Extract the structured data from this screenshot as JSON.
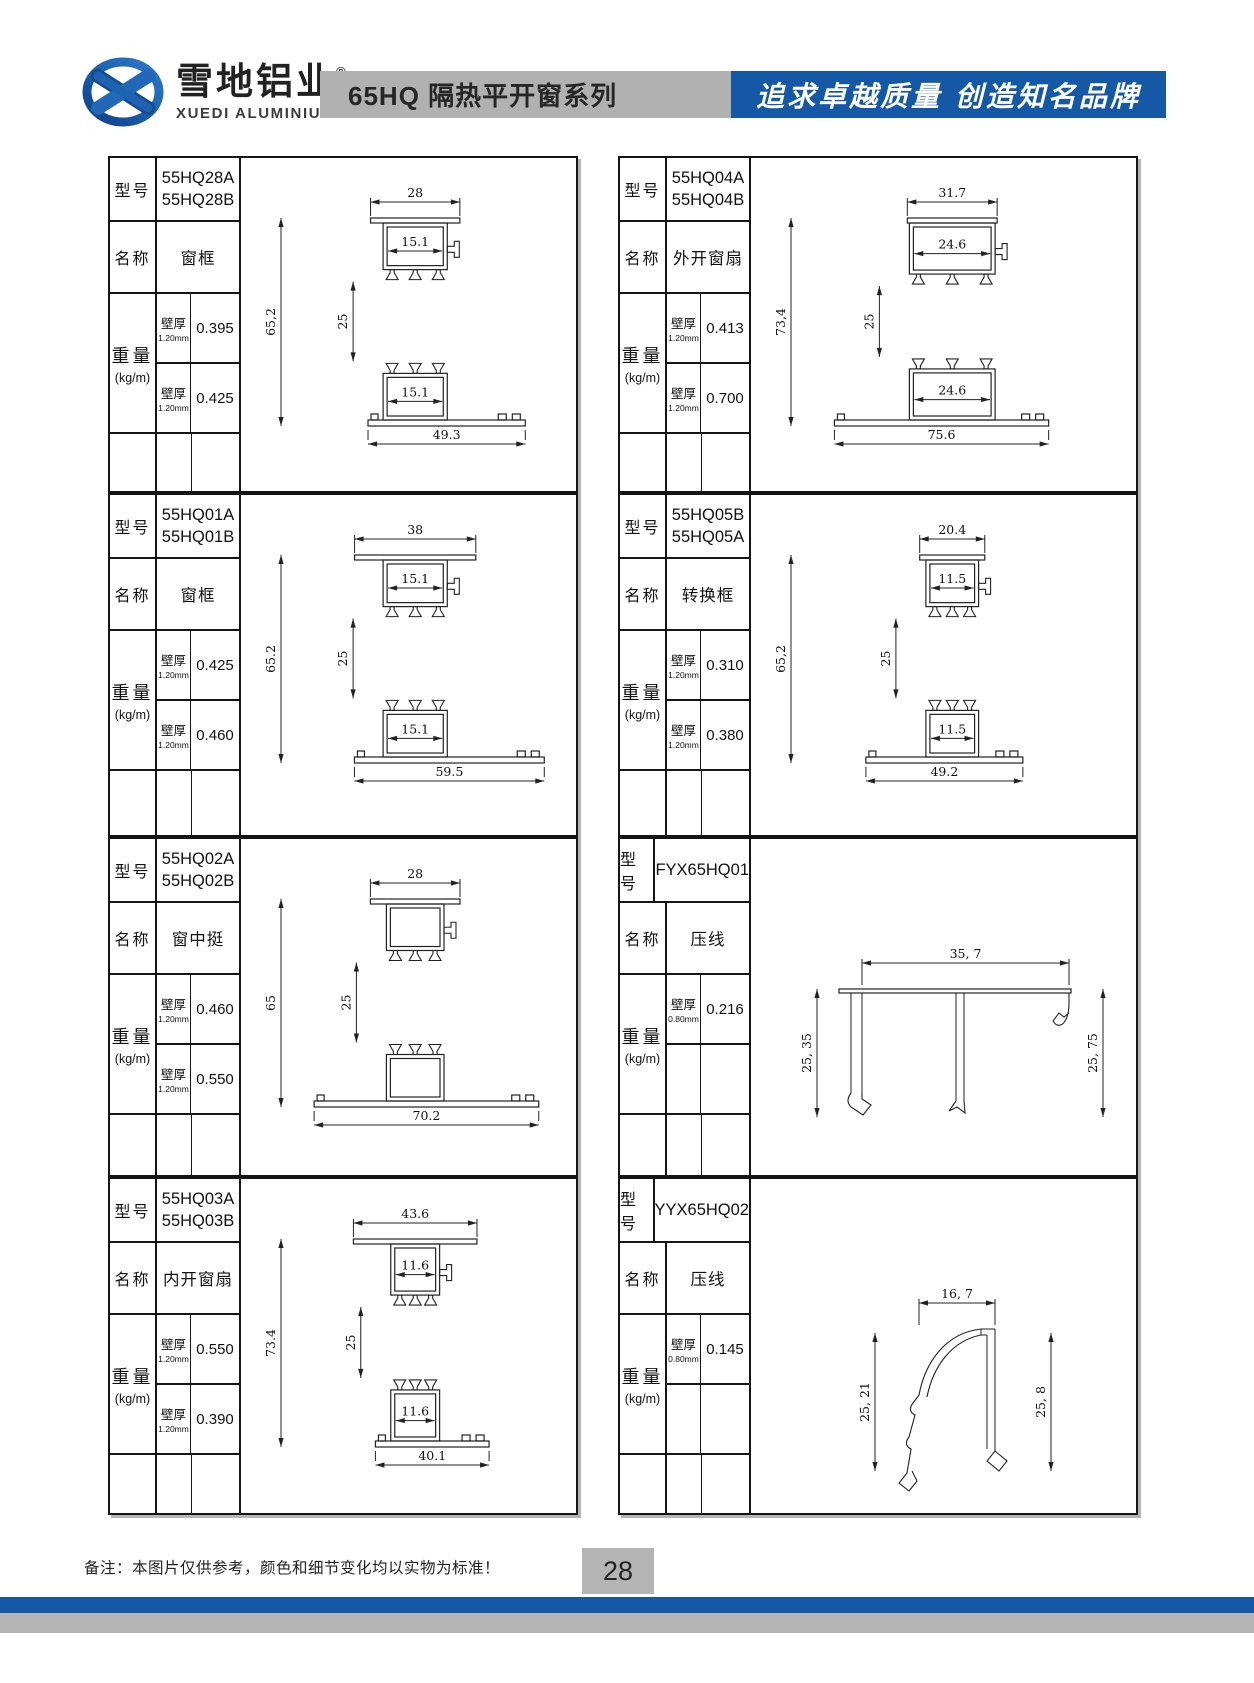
{
  "header": {
    "logo_cn": "雪地铝业",
    "logo_reg": "®",
    "logo_en": "XUEDI ALUMINIUM",
    "series_title": "65HQ 隔热平开窗系列",
    "slogan": "追求卓越质量 创造知名品牌",
    "colors": {
      "accent_blue": "#1458a6",
      "bar_gray": "#b1b1b1"
    }
  },
  "labels": {
    "model": "型号",
    "name": "名称",
    "weight": "重量",
    "weight_unit": "(kg/m)",
    "wall": "壁厚"
  },
  "cells": [
    {
      "models": [
        "55HQ28A",
        "55HQ28B"
      ],
      "name": "窗框",
      "weights": [
        {
          "wall": "1.20mm",
          "value": "0.395"
        },
        {
          "wall": "1.20mm",
          "value": "0.425"
        }
      ],
      "dims": {
        "top": "28",
        "inner_top": "15.1",
        "height": "65,2",
        "mid": "25",
        "inner_bottom": "15.1",
        "bottom": "49.3"
      }
    },
    {
      "models": [
        "55HQ04A",
        "55HQ04B"
      ],
      "name": "外开窗扇",
      "weights": [
        {
          "wall": "1.20mm",
          "value": "0.413"
        },
        {
          "wall": "1.20mm",
          "value": "0.700"
        }
      ],
      "dims": {
        "top": "31.7",
        "inner_top": "24.6",
        "height": "73,4",
        "mid": "25",
        "inner_bottom": "24.6",
        "bottom": "75.6"
      }
    },
    {
      "models": [
        "55HQ01A",
        "55HQ01B"
      ],
      "name": "窗框",
      "weights": [
        {
          "wall": "1.20mm",
          "value": "0.425"
        },
        {
          "wall": "1.20mm",
          "value": "0.460"
        }
      ],
      "dims": {
        "top": "38",
        "inner_top": "15.1",
        "height": "65.2",
        "mid": "25",
        "inner_bottom": "15.1",
        "bottom": "59.5"
      }
    },
    {
      "models": [
        "55HQ05B",
        "55HQ05A"
      ],
      "name": "转换框",
      "weights": [
        {
          "wall": "1.20mm",
          "value": "0.310"
        },
        {
          "wall": "1.20mm",
          "value": "0.380"
        }
      ],
      "dims": {
        "top": "20.4",
        "inner_top": "11.5",
        "height": "65,2",
        "mid": "25",
        "inner_bottom": "11.5",
        "bottom": "49.2"
      }
    },
    {
      "models": [
        "55HQ02A",
        "55HQ02B"
      ],
      "name": "窗中挺",
      "weights": [
        {
          "wall": "1.20mm",
          "value": "0.460"
        },
        {
          "wall": "1.20mm",
          "value": "0.550"
        }
      ],
      "dims": {
        "top": "28",
        "height": "65",
        "mid": "25",
        "bottom": "70.2"
      }
    },
    {
      "models": [
        "FYX65HQ01"
      ],
      "name": "压线",
      "weights": [
        {
          "wall": "0.80mm",
          "value": "0.216"
        },
        {
          "wall": "",
          "value": ""
        }
      ],
      "dims": {
        "top": "35, 7",
        "left": "25, 35",
        "right": "25, 75"
      }
    },
    {
      "models": [
        "55HQ03A",
        "55HQ03B"
      ],
      "name": "内开窗扇",
      "weights": [
        {
          "wall": "1.20mm",
          "value": "0.550"
        },
        {
          "wall": "1.20mm",
          "value": "0.390"
        }
      ],
      "dims": {
        "top": "43.6",
        "inner_top": "11.6",
        "height": "73.4",
        "mid": "25",
        "inner_bottom": "11.6",
        "bottom": "40.1"
      }
    },
    {
      "models": [
        "YYX65HQ02"
      ],
      "name": "压线",
      "weights": [
        {
          "wall": "0.80mm",
          "value": "0.145"
        },
        {
          "wall": "",
          "value": ""
        }
      ],
      "dims": {
        "top": "16, 7",
        "left": "25, 21",
        "right": "25, 8"
      }
    }
  ],
  "footer": {
    "note": "备注：本图片仅供参考，颜色和细节变化均以实物为标准！",
    "page": "28"
  }
}
